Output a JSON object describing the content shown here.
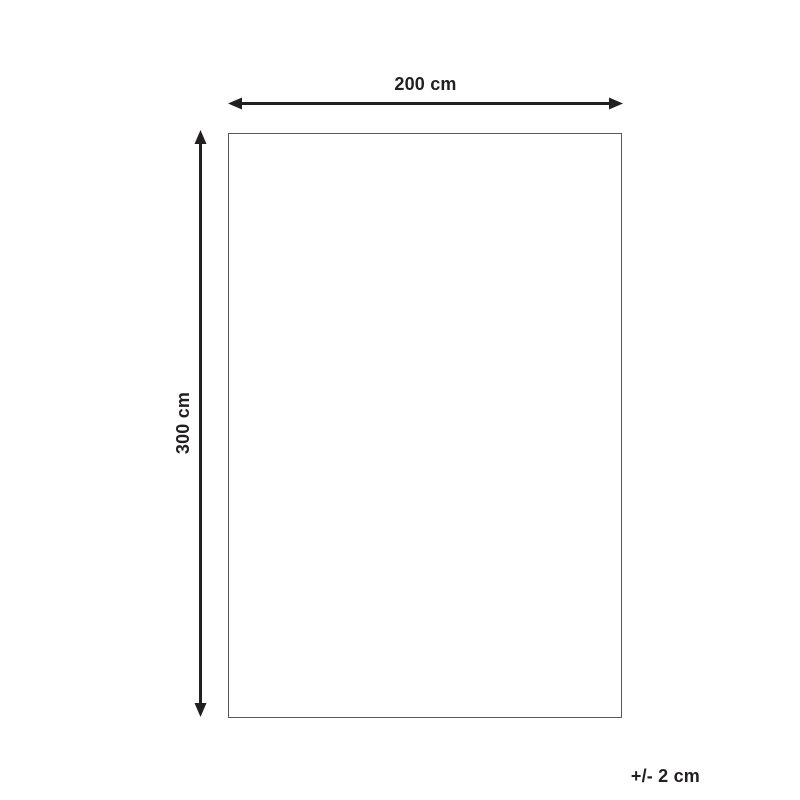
{
  "diagram": {
    "width_label": "200 cm",
    "height_label": "300 cm",
    "tolerance_label": "+/- 2 cm",
    "colors": {
      "arrow": "#231f20",
      "text": "#231f20",
      "outline": "#58595b",
      "background": "#ffffff"
    }
  }
}
